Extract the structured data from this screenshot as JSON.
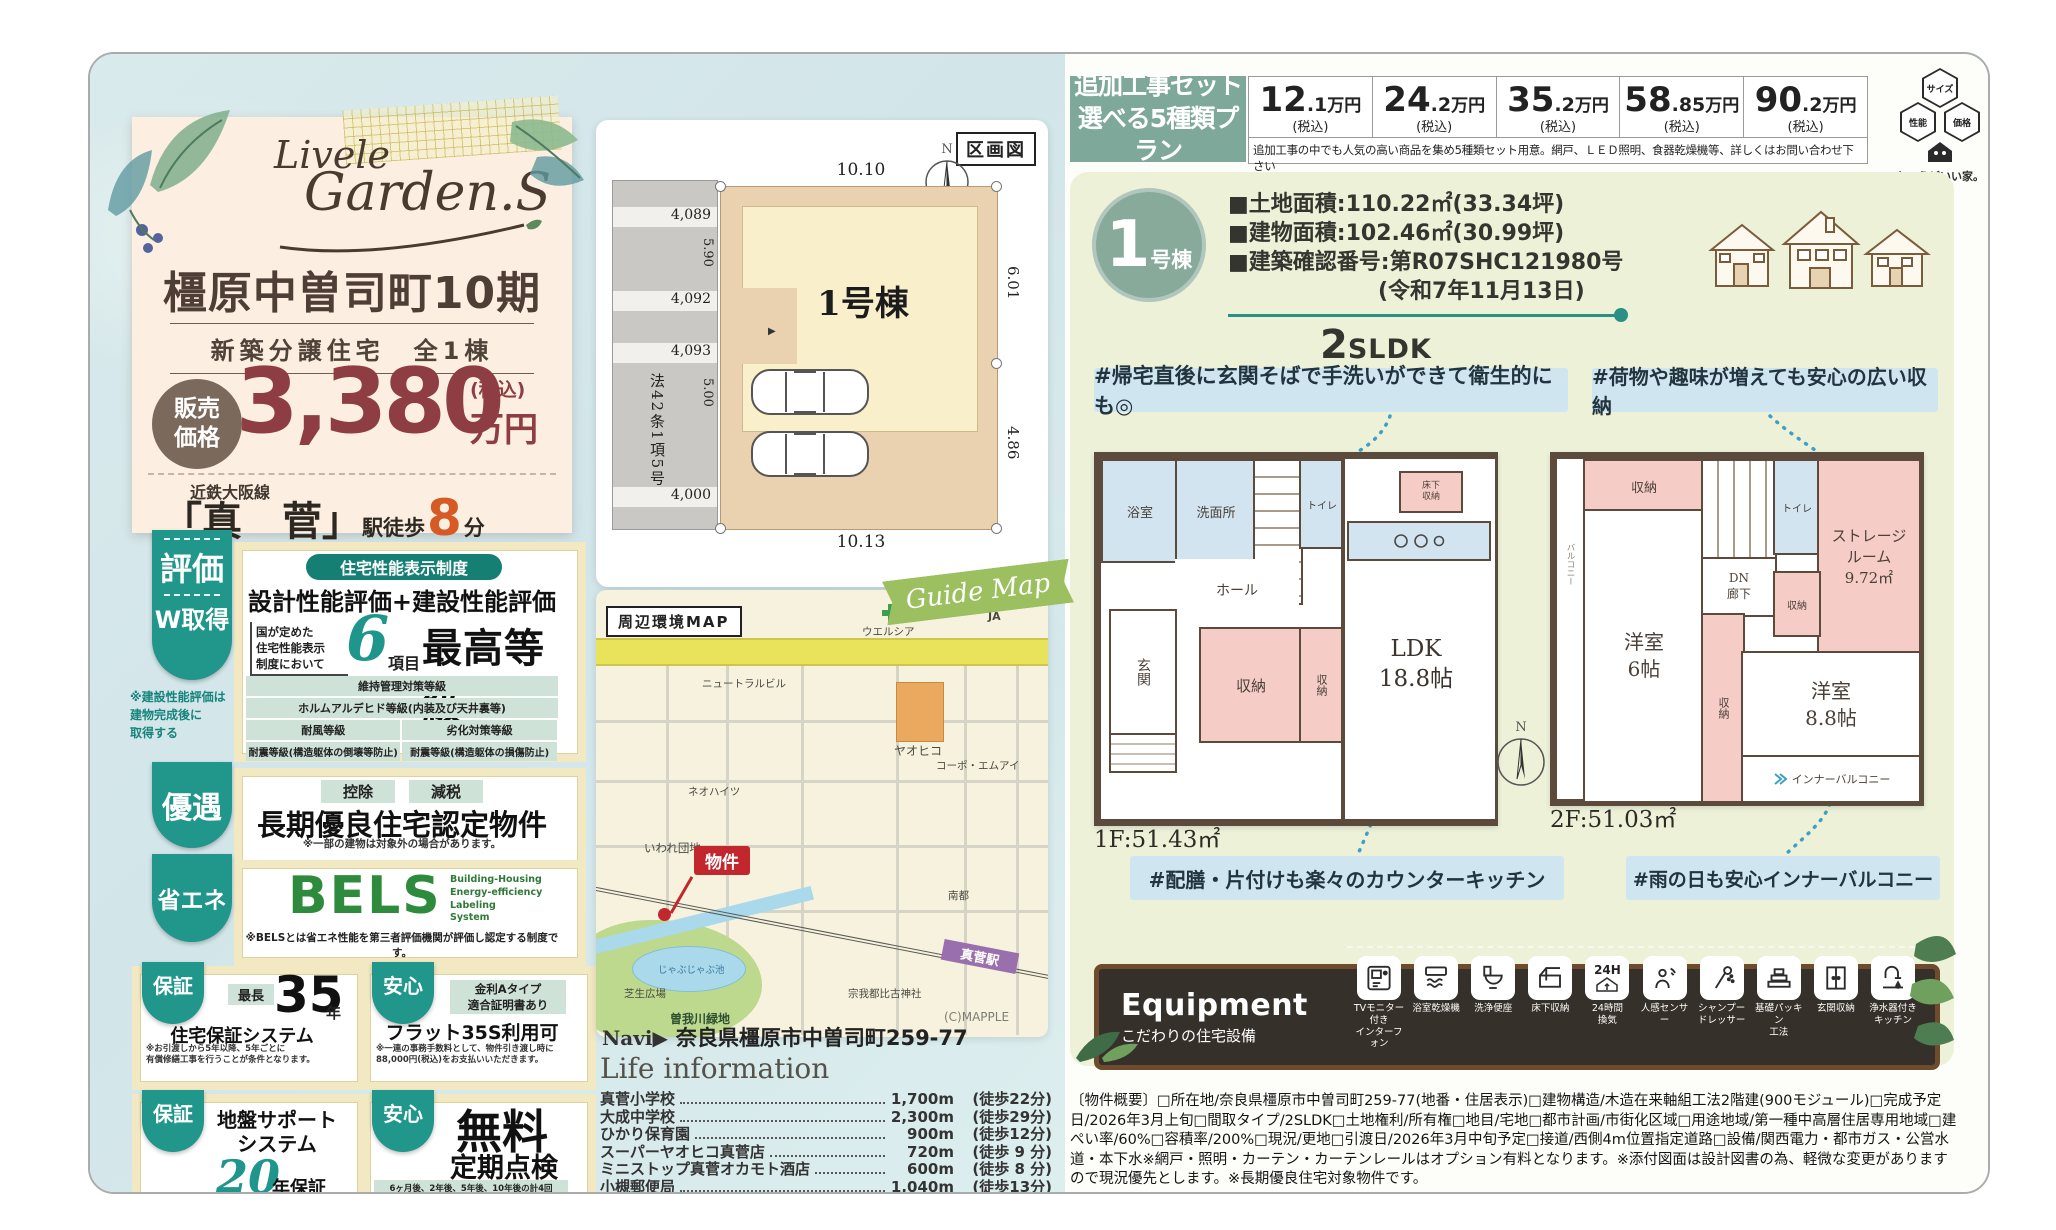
{
  "colors": {
    "teal": "#21968b",
    "sage": "#7ea89a",
    "price_red": "#8e3e43",
    "orange": "#d55a26",
    "panel_green": "#ecf1d8",
    "callout_blue": "#cfe6f0",
    "room_pink": "#f5cdc6",
    "room_blue": "#d3e4f1",
    "equipment_wood": "#6d4b2c",
    "station_purple": "#9a6fae",
    "map_marker_red": "#c2272d"
  },
  "brand": {
    "logo_line1": "Livele",
    "logo_line2": "Garden.S",
    "title": "橿原中曽司町10期",
    "subtitle": "新築分譲住宅　全1棟",
    "price_badge": "販売\n価格",
    "price_value": "3,380",
    "price_tax": "(税込)",
    "price_unit": "万円",
    "rail_line": "近鉄大阪線",
    "station_name": "「真　菅」",
    "station_walk": "駅徒歩",
    "walk_minutes": "8",
    "walk_unit": "分"
  },
  "badges": {
    "eval_tab1": "評価",
    "eval_tab2": "W取得",
    "eval_header": "住宅性能表示制度",
    "eval_title": "設計性能評価+建設性能評価",
    "eval_lead": "国が定めた\n住宅性能表示\n制度において",
    "eval_count": "6",
    "eval_count_unit": "項目",
    "eval_grade": "最高等級",
    "eval_items": [
      "維持管理対策等級",
      "ホルムアルデヒド等級(内装及び天井裏等)",
      "耐風等級",
      "劣化対策等級",
      "耐震等級(構造躯体の倒壊等防止)",
      "耐震等級(構造躯体の損傷防止)"
    ],
    "eval_note": "※建設性能評価は\n建物完成後に\n取得する",
    "yuguu_tab": "優遇",
    "yuguu_chip1": "控除",
    "yuguu_chip2": "減税",
    "yuguu_title": "長期優良住宅認定物件",
    "yuguu_note": "※一部の建物は対象外の場合があります。",
    "shoene_tab": "省エネ",
    "bels_logo": "BELS",
    "bels_sub": "Building-Housing\nEnergy-efficiency\nLabeling\nSystem",
    "bels_note": "※BELSとは省エネ性能を第三者評価機関が評価し認定する制度です。",
    "hosho_tab": "保証",
    "hosho_chip": "最長",
    "hosho_num": "35",
    "hosho_num_unit": "年",
    "hosho_title": "住宅保証システム",
    "hosho_note": "※お引渡しから5年以降、5年ごとに\n有償修繕工事を行うことが条件となります。",
    "anshin_tab": "安心",
    "flat_chip": "金利Aタイプ\n適合証明書あり",
    "flat_title": "フラット35S利用可",
    "flat_note": "※一連の事務手数料として、物件引き渡し時に\n88,000円(税込)をお支払いいただきます。",
    "jiban_tab": "保証",
    "jiban_title": "地盤サポート\nシステム",
    "jiban_num": "20",
    "jiban_num_unit": "年保証",
    "tenken_tab": "安心",
    "tenken_title1": "無料",
    "tenken_title2": "定期点検",
    "tenken_note": "6ヶ月後、2年後、5年後、10年後の計4回"
  },
  "plot": {
    "title": "区画図",
    "north": "N",
    "building": "1号棟",
    "entry_marker": "▶",
    "dim_top": "10.10",
    "dim_bottom": "10.13",
    "dim_right_upper": "6.01",
    "dim_right_lower": "4.86",
    "dim_left_upper": "5.90",
    "dim_left_lower": "5.00",
    "roads": [
      "4,089",
      "4,092",
      "4,093",
      "4,000"
    ],
    "law": "法42条1項5号"
  },
  "map": {
    "title": "周辺環境MAP",
    "ribbon": "Guide Map",
    "road_label": "大和高田桜井線",
    "marker": "物件",
    "station": "真菅駅",
    "credit": "(C)MAPPLE",
    "labels": [
      "ウエルシア",
      "JA",
      "ニュートラルビル",
      "ヤオヒコ",
      "コーポ・エムアイ",
      "ネオハイツ",
      "いわれ団地",
      "南都",
      "宗我都比古神社",
      "芝生広場",
      "じゃぶじゃぶ池",
      "曽我川緑地"
    ]
  },
  "navi_label": "Navi▶",
  "navi_address": "奈良県橿原市中曽司町259-77",
  "life_title": "Life information",
  "life_items": [
    {
      "name": "真菅小学校",
      "dist": "1,700m",
      "walk": "(徒歩22分)"
    },
    {
      "name": "大成中学校",
      "dist": "2,300m",
      "walk": "(徒歩29分)"
    },
    {
      "name": "ひかり保育園",
      "dist": "900m",
      "walk": "(徒歩12分)"
    },
    {
      "name": "スーパーヤオヒコ真菅店",
      "dist": "720m",
      "walk": "(徒歩 9 分)"
    },
    {
      "name": "ミニストップ真菅オカモト酒店",
      "dist": "600m",
      "walk": "(徒歩 8 分)"
    },
    {
      "name": "小槻郵便局",
      "dist": "1,040m",
      "walk": "(徒歩13分)"
    }
  ],
  "topbar": {
    "label": "追加工事セット\n選べる5種類プラン",
    "unit": "万円",
    "tax": "(税込)",
    "plans": [
      {
        "int": "12",
        "frac": ".1"
      },
      {
        "int": "24",
        "frac": ".2"
      },
      {
        "int": "35",
        "frac": ".2"
      },
      {
        "int": "58",
        "frac": ".85"
      },
      {
        "int": "90",
        "frac": ".2"
      }
    ],
    "note": "追加工事の中でも人気の高い商品を集め5種類セット用意。網戸、ＬＥＤ照明、食器乾燥機等、詳しくはお問い合わせ下さい"
  },
  "quality": {
    "hex1": "サイズ",
    "hex2": "性能",
    "hex3": "価格",
    "caption": "ちょうどいい家。"
  },
  "unit": {
    "num": "1",
    "num_suffix": "号棟",
    "specs": [
      "■土地面積:110.22㎡(33.34坪)",
      "■建物面積:102.46㎡(30.99坪)",
      "■建築確認番号:第R07SHC121980号",
      "(令和7年11月13日)"
    ],
    "plan_big": "2",
    "plan_small": "SLDK"
  },
  "callouts": {
    "wash": "#帰宅直後に玄関そばで手洗いができて衛生的にも◎",
    "storage": "#荷物や趣味が増えても安心の広い収納",
    "kitchen": "#配膳・片付けも楽々のカウンターキッチン",
    "balcony": "#雨の日も安心インナーバルコニー"
  },
  "floor1": {
    "label": "1F:51.43㎡",
    "bath": "浴室",
    "wash": "洗面所",
    "toilet": "トイレ",
    "up": "UP",
    "hall": "ホール",
    "entrance": "玄関",
    "storage1": "収納",
    "storage2": "収納",
    "ldk": "LDK\n18.8帖",
    "floor_storage": "床下\n収納"
  },
  "floor2": {
    "label": "2F:51.03㎡",
    "balcony": "バルコニー",
    "storage1": "収納",
    "room6": "洋室\n6帖",
    "dn": "DN\n廊下",
    "toilet": "トイレ",
    "storage_room": "ストレージ\nルーム\n9.72㎡",
    "storage2": "収納",
    "storage3": "収納",
    "room88": "洋室\n8.8帖",
    "inner_balcony": "インナーバルコニー"
  },
  "equipment": {
    "title": "Equipment",
    "subtitle": "こだわりの住宅設備",
    "vent_badge": "24H",
    "items": [
      "TVモニター付き\nインターフォン",
      "浴室乾燥機",
      "洗浄便座",
      "床下収納",
      "24時間\n換気",
      "人感センサー",
      "シャンプー\nドレッサー",
      "基礎パッキン\n工法",
      "玄関収納",
      "浄水器付き\nキッチン"
    ]
  },
  "outline": "〔物件概要〕□所在地/奈良県橿原市中曽司町259-77(地番・住居表示)□建物構造/木造在来軸組工法2階建(900モジュール)□完成予定日/2026年3月上旬□間取タイプ/2SLDK□土地権利/所有権□地目/宅地□都市計画/市街化区域□用途地域/第一種中高層住居専用地域□建ぺい率/60%□容積率/200%□現況/更地□引渡日/2026年3月中旬予定□接道/西側4m位置指定道路□設備/関西電力・都市ガス・公営水道・本下水※網戸・照明・カーテン・カーテンレールはオプション有料となります。※添付図面は設計図書の為、軽微な変更がありますので現況優先とします。※長期優良住宅対象物件です。"
}
